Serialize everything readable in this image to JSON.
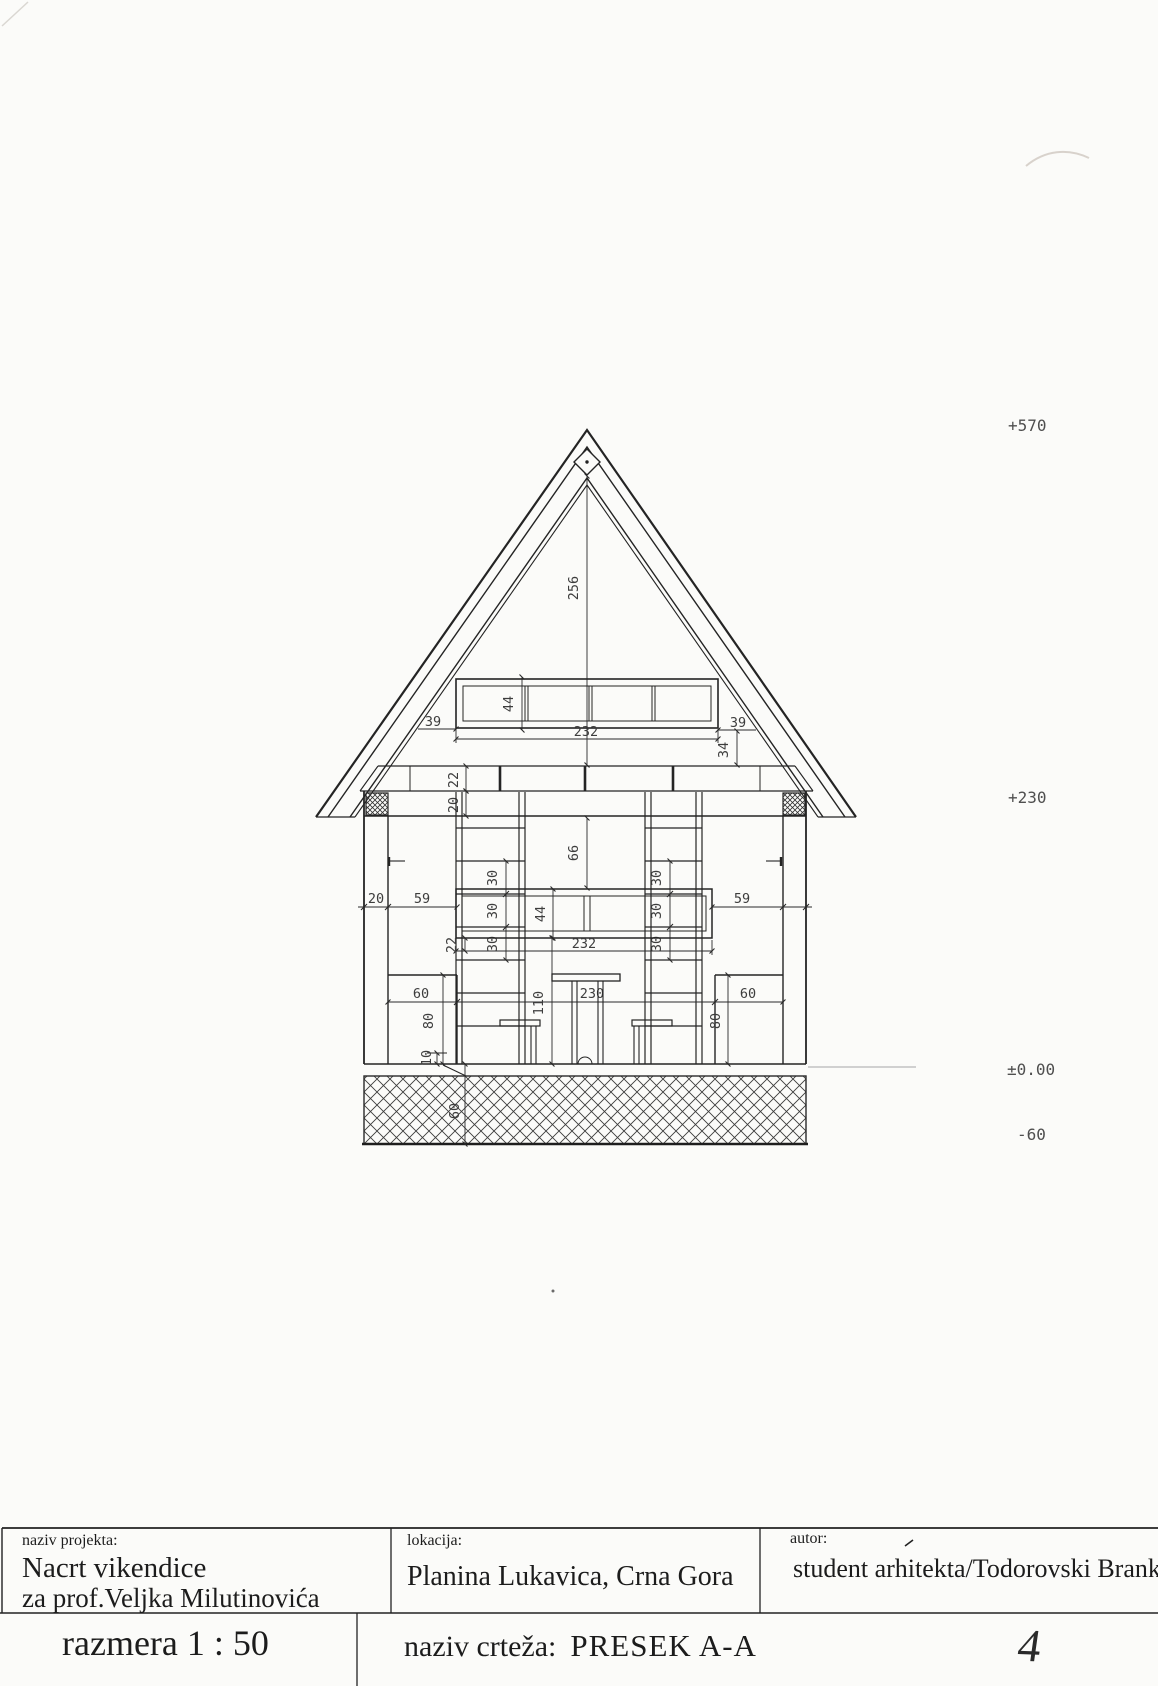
{
  "drawing": {
    "elevations": {
      "ridge": "+570",
      "eave": "+230",
      "ground": "±0.00",
      "foundation": "-60"
    },
    "dims": {
      "ridge_height": "256",
      "gable_window_height": "44",
      "gable_window_width": "232",
      "gable_offset_left": "39",
      "gable_offset_right": "39",
      "gable_sill_drop": "34",
      "band_upper": "22",
      "band_lower": "20",
      "wall_thickness": "20",
      "window_offset_left": "59",
      "window_offset_right": "59",
      "window_height": "44",
      "window_width": "232",
      "window_drop": "66",
      "sill_band": "22",
      "sill_height": "110",
      "shelf_spacing": [
        "30",
        "30",
        "30",
        "30",
        "30",
        "30"
      ],
      "bench_width_left": "60",
      "bench_width_right": "60",
      "bench_height_left": "80",
      "bench_height_right": "80",
      "interior_width": "230",
      "floor_step": "10",
      "foundation_depth": "60"
    }
  },
  "title_block": {
    "project_label": "naziv projekta:",
    "project_name": "Nacrt vikendice",
    "project_client": "za prof.Veljka Milutinovića",
    "location_label": "lokacija:",
    "location": "Planina Lukavica, Crna Gora",
    "author_label": "autor:",
    "author": "student arhitekta/Todorovski Branko",
    "scale": "razmera 1 : 50",
    "drawing_label": "naziv crteža:",
    "drawing_name": "PRESEK A-A",
    "sheet_number": "4"
  }
}
